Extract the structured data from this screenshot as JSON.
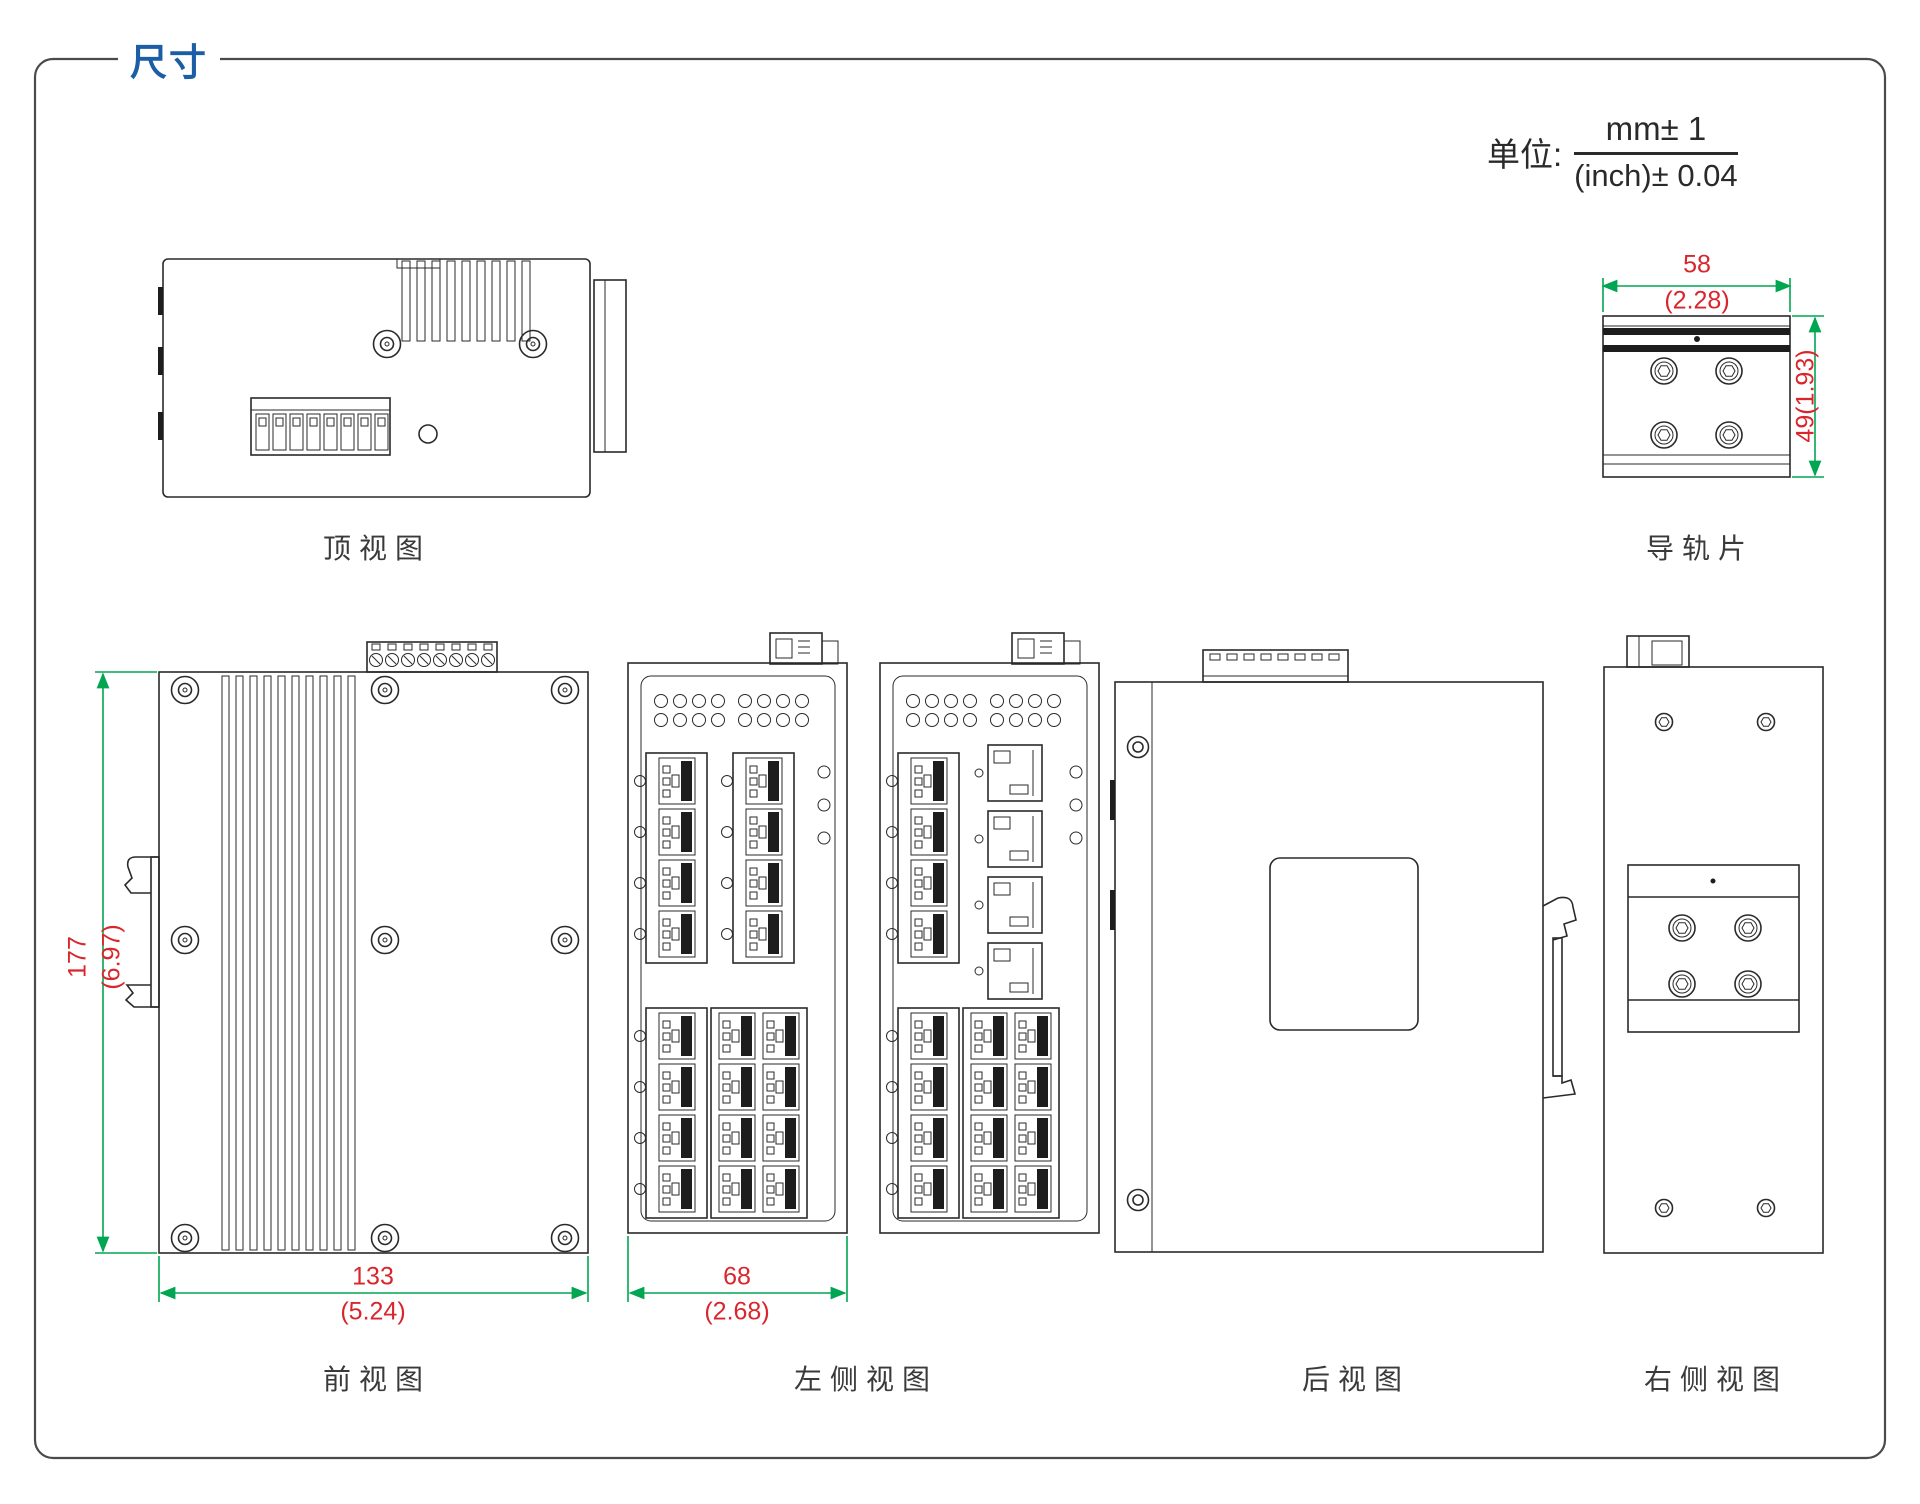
{
  "page": {
    "title": "尺寸"
  },
  "units": {
    "label": "单位:",
    "numerator": "mm± 1",
    "denominator": "(inch)± 0.04"
  },
  "views": {
    "top": {
      "label": "顶视图"
    },
    "rail": {
      "label": "导轨片",
      "width_mm": "58",
      "width_inch": "(2.28)",
      "height": "49(1.93)"
    },
    "front": {
      "label": "前视图",
      "height_mm": "177",
      "height_inch": "(6.97)",
      "width_mm": "133",
      "width_inch": "(5.24)"
    },
    "left": {
      "label": "左侧视图",
      "width_mm": "68",
      "width_inch": "(2.68)"
    },
    "rear": {
      "label": "后视图"
    },
    "right": {
      "label": "右侧视图"
    }
  },
  "colors": {
    "accent": "#1b5ea6",
    "dim_text": "#d9262c",
    "dim_line": "#00a651",
    "line": "#2a2a2a"
  }
}
